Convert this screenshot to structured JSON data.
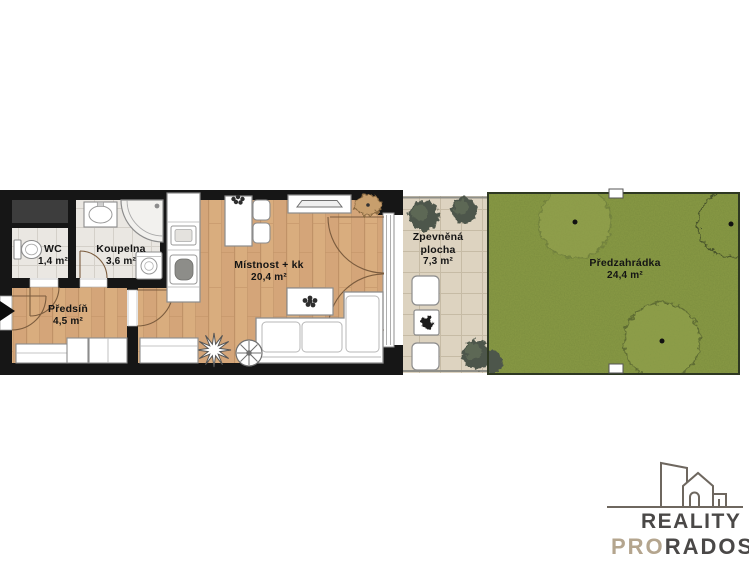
{
  "rooms": {
    "wc": {
      "name": "WC",
      "area": "1,4 m²"
    },
    "koupelna": {
      "name": "Koupelna",
      "area": "3,6 m²"
    },
    "predsin": {
      "name": "Předsíň",
      "area": "4,5 m²"
    },
    "mistnost": {
      "name": "Místnost + kk",
      "area": "20,4 m²"
    },
    "zpevnena": {
      "name_line1": "Zpevněná",
      "name_line2": "plocha",
      "area": "7,3 m²"
    },
    "predzahradka": {
      "name": "Předzahrádka",
      "area": "24,4 m²"
    }
  },
  "logo": {
    "brand_line1": "REALITY",
    "brand_line2_accent": "PRO",
    "brand_line2_rest": "RADOST"
  },
  "colors": {
    "wall": "#161616",
    "shaft_gray": "#3d3d3d",
    "wood_floor": "#d9ad7e",
    "tile_floor": "#eae7e2",
    "paving": "#ddd3c0",
    "grass": "#8a9b45",
    "bush": "#4e574b",
    "label_text": "#141414",
    "logo_gray": "#4a4847",
    "logo_tan": "#b4a58e"
  }
}
